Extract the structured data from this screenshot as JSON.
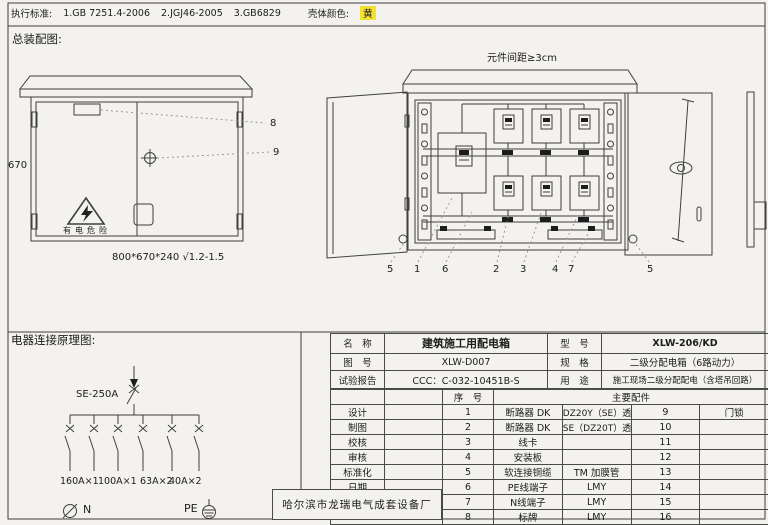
{
  "header": {
    "exec_label": "执行标准:",
    "standards": [
      "1.GB 7251.4-2006",
      "2.JGJ46-2005",
      "3.GB6829"
    ],
    "shell_label": "壳体颜色:",
    "shell_value": "黄",
    "shell_highlight_color": "#f2e032"
  },
  "assembly": {
    "title": "总装配图:",
    "front": {
      "height_dim": "670",
      "danger_text": "有电危险",
      "size_note": "800*670*240 √1.2-1.5",
      "callout_8": "8",
      "callout_9": "9"
    },
    "open": {
      "spacing_note": "元件间距≥3cm",
      "callouts": [
        "5",
        "1",
        "6",
        "2",
        "3",
        "4",
        "7",
        "5"
      ]
    }
  },
  "schematic": {
    "title": "电器连接原理图:",
    "main_breaker": "SE-250A",
    "branches": [
      "160A×1",
      "100A×1",
      "63A×2",
      "40A×2"
    ],
    "neutral": "N",
    "pe": "PE"
  },
  "title_block": {
    "info": [
      {
        "k1": "名　称",
        "v1": "建筑施工用配电箱",
        "k2": "型　号",
        "v2": "XLW-206/KD"
      },
      {
        "k1": "图　号",
        "v1": "XLW-D007",
        "k2": "规　格",
        "v2": "二级分配电箱（6路动力）"
      },
      {
        "k1": "试验报告",
        "v1": "CCC：C-032-10451B-S",
        "k2": "用　途",
        "v2": "施工现场二级分配配电（含塔吊回路）"
      }
    ],
    "seq_header": "序　号",
    "parts_header": "主要配件",
    "sign_labels": [
      "设计",
      "制图",
      "校核",
      "审核",
      "标准化",
      "日期"
    ],
    "parts": [
      {
        "no": "1",
        "name": "断路器 DK",
        "spec": "DZ20Y（SE）透明系列",
        "no2": "9",
        "name2": "门锁"
      },
      {
        "no": "2",
        "name": "断路器 DK",
        "spec": "SE（DZ20T）透明系列",
        "no2": "10",
        "name2": ""
      },
      {
        "no": "3",
        "name": "线卡",
        "spec": "",
        "no2": "11",
        "name2": ""
      },
      {
        "no": "4",
        "name": "安装板",
        "spec": "",
        "no2": "12",
        "name2": ""
      },
      {
        "no": "5",
        "name": "软连接铜缆",
        "spec": "TM 加膜管",
        "no2": "13",
        "name2": ""
      },
      {
        "no": "6",
        "name": "PE线端子",
        "spec": "LMY",
        "no2": "14",
        "name2": ""
      },
      {
        "no": "7",
        "name": "N线端子",
        "spec": "LMY",
        "no2": "15",
        "name2": ""
      },
      {
        "no": "8",
        "name": "标牌",
        "spec": "LMY",
        "no2": "16",
        "name2": ""
      }
    ],
    "manufacturer": "哈尔滨市龙瑞电气成套设备厂"
  }
}
